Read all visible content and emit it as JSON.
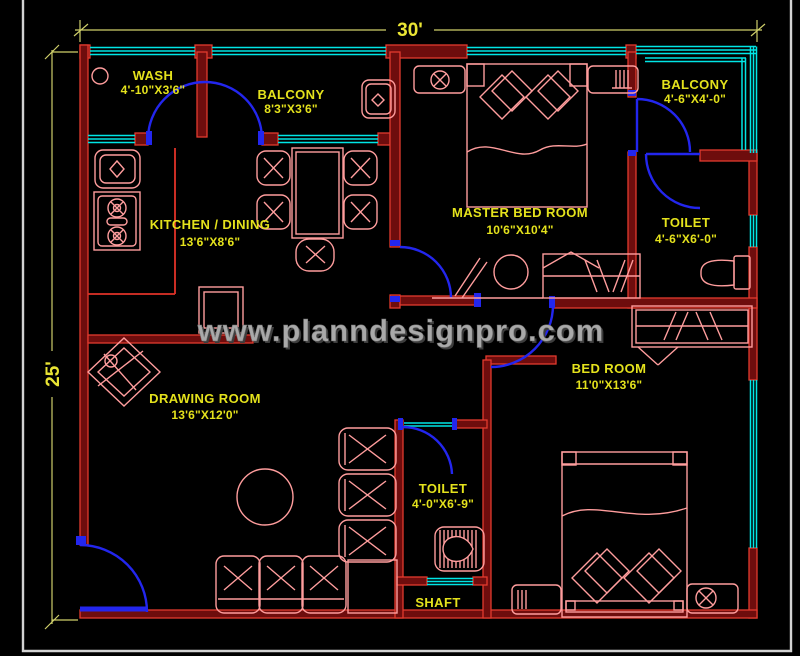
{
  "title": "House Floor Plan 30' x 25'",
  "watermark": "www.planndesignpro.com",
  "dimensions": {
    "width_label": "30'",
    "height_label": "25'"
  },
  "rooms": [
    {
      "id": "wash",
      "name": "WASH",
      "size": "4'-10\"X3'6\""
    },
    {
      "id": "balcony_top",
      "name": "BALCONY",
      "size": "8'3\"X3'6\""
    },
    {
      "id": "kitchen_dining",
      "name": "KITCHEN / DINING",
      "size": "13'6\"X8'6\""
    },
    {
      "id": "master_bed",
      "name": "MASTER BED ROOM",
      "size": "10'6\"X10'4\""
    },
    {
      "id": "balcony_right",
      "name": "BALCONY",
      "size": "4'-6\"X4'-0\""
    },
    {
      "id": "toilet_top",
      "name": "TOILET",
      "size": "4'-6\"X6'-0\""
    },
    {
      "id": "drawing_room",
      "name": "DRAWING ROOM",
      "size": "13'6\"X12'0\""
    },
    {
      "id": "bed_room",
      "name": "BED ROOM",
      "size": "11'0\"X13'6\""
    },
    {
      "id": "toilet_bottom",
      "name": "TOILET",
      "size": "4'-0\"X6'-9\""
    },
    {
      "id": "shaft",
      "name": "SHAFT",
      "size": ""
    }
  ],
  "colors": {
    "background": "#000000",
    "wall_fill": "#6e0d0d",
    "wall_edge": "#e23b2e",
    "window_cyan": "#00e5e5",
    "door_blue": "#2326ee",
    "furniture_pink": "#ff9d9d",
    "text_yellow": "#e4e21c",
    "dimension_yellow": "#cfcf6a",
    "watermark_gray": "#a9a9a9",
    "viewport_border": "#d2d2d2"
  }
}
